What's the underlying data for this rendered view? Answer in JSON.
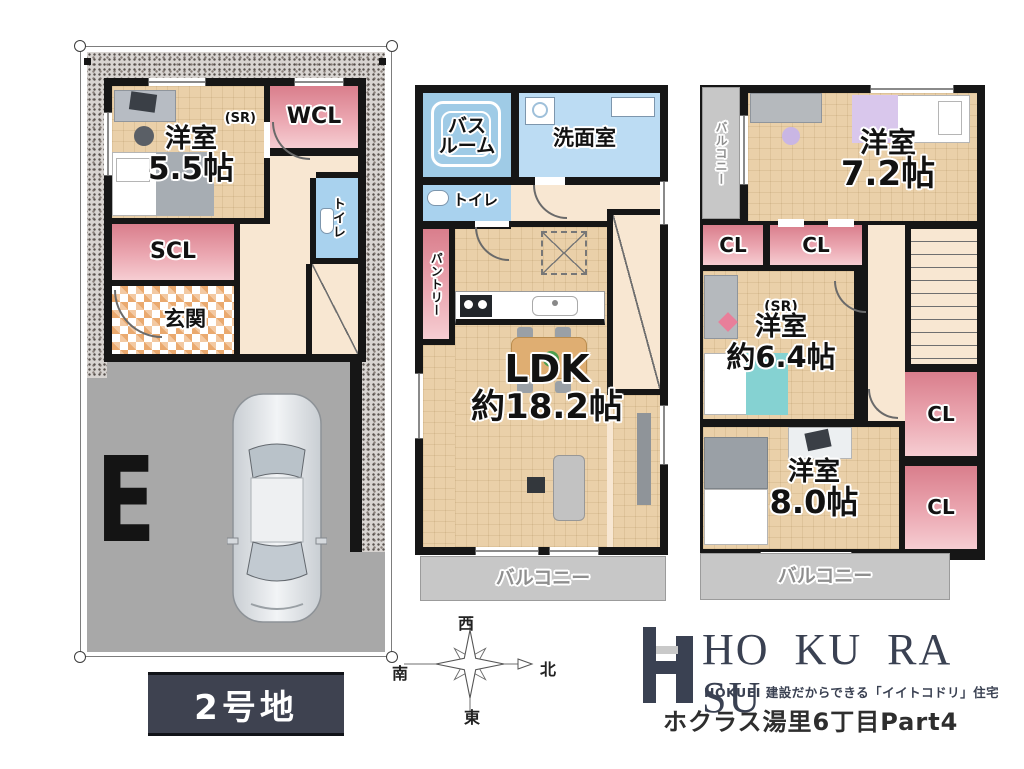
{
  "site": {
    "lot_badge": "2号地",
    "parking_mark": "E"
  },
  "floor1": {
    "room1": {
      "tag": "(SR)",
      "name": "洋室",
      "size": "5.5帖"
    },
    "wcl": "WCL",
    "toilet": "トイレ",
    "scl": "SCL",
    "entrance": "玄関"
  },
  "floor2": {
    "bath_line1": "バス",
    "bath_line2": "ルーム",
    "washroom": "洗面室",
    "toilet": "トイレ",
    "pantry": "パントリー",
    "ldk": {
      "name": "LDK",
      "size": "約18.2帖"
    },
    "balcony": "バルコニー"
  },
  "floor3": {
    "balcony_side": "バルコニー",
    "room1": {
      "name": "洋室",
      "size": "7.2帖"
    },
    "cl": "CL",
    "room2": {
      "tag": "(SR)",
      "name": "洋室",
      "size": "約6.4帖"
    },
    "room3": {
      "name": "洋室",
      "size": "8.0帖"
    },
    "balcony": "バルコニー"
  },
  "compass": {
    "west": "西",
    "north": "北",
    "south": "南",
    "east": "東"
  },
  "brand": {
    "logo": "HO KU RA SU",
    "tagline": "HOKUEI 建設だからできる「イイトコドリ」住宅",
    "project": "ホクラス湯里6丁目Part4"
  },
  "colors": {
    "wall": "#161616",
    "room_tan": "#ead0a9",
    "closet_pink": "#d97e8c",
    "water_blue": "#9fcbe6",
    "hall_peach": "#f8e7d2",
    "balcony_gray": "#c7c7c7",
    "parking_gray": "#a8a8a8",
    "badge_navy": "#3e4250",
    "brand_navy": "#3a4152"
  }
}
